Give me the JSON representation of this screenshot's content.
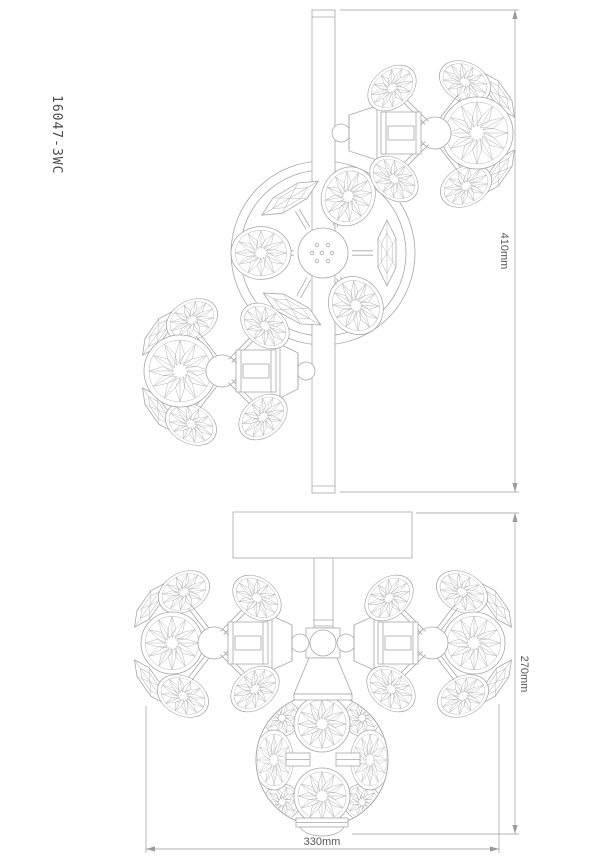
{
  "colors": {
    "background": "#ffffff",
    "line": "#a8a8a8",
    "fine_line": "#b6b6b6",
    "dimension_line": "#9b9b9b",
    "dimension_text": "#585858",
    "model_text": "#4d4d4d"
  },
  "drawing": {
    "model_label": "16047-3WC",
    "dimensions": {
      "mount_bar_length": "410mm",
      "fixture_height": "270mm",
      "fixture_width": "330mm"
    }
  }
}
